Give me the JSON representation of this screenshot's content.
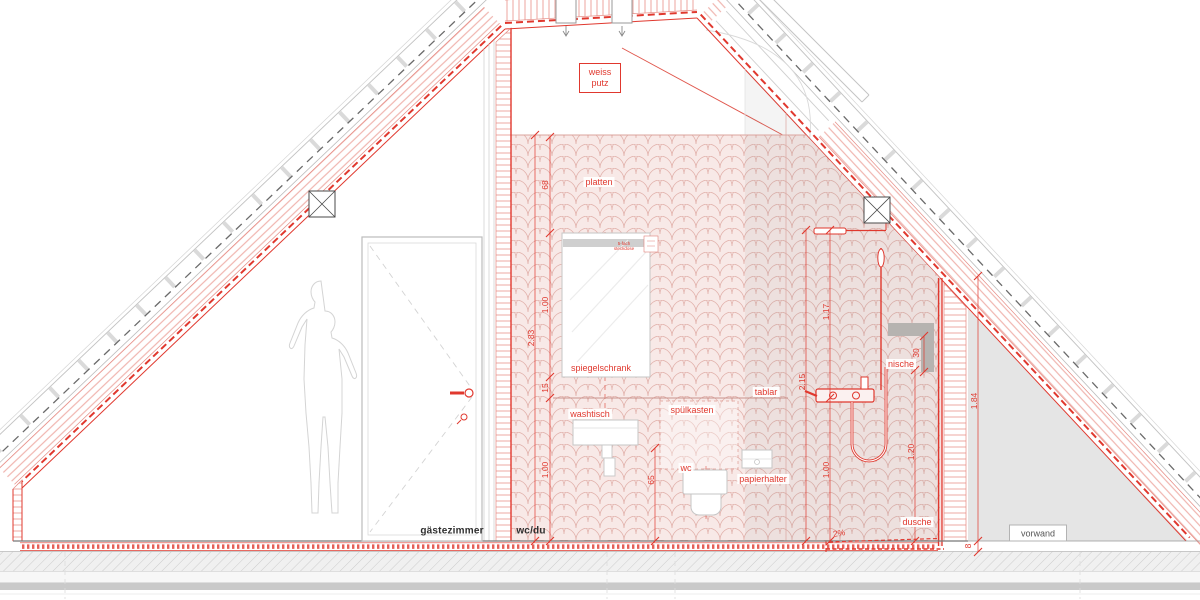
{
  "labels": {
    "weiss_putz_line1": "weiss",
    "weiss_putz_line2": "putz",
    "platten": "platten",
    "spiegelschrank": "spiegelschrank",
    "steckdose_line1": "5-fach",
    "steckdose_line2": "steckdose",
    "washtisch": "washtisch",
    "spuelkasten": "spülkasten",
    "tablar": "tablar",
    "wc": "wc",
    "papierhalter": "papierhalter",
    "dusche": "dusche",
    "nische": "nische",
    "gaestezimmer": "gästezimmer",
    "wc_du": "wc/du",
    "vorwand": "vorwand"
  },
  "dimensions": {
    "wall_height_total": "2.83",
    "tile_band_top": "68",
    "mirror_cabinet_height": "1.00",
    "gap_cabinet_shelf": "15",
    "shelf_height": "1.00",
    "basin_clearance": "65",
    "shower_height": "2.15",
    "head_to_mixer": "1.17",
    "mixer_height": "1.00",
    "niche_bottom_height": "1.20",
    "niche_size": "30",
    "vorwand_height": "1.84",
    "floor_thickness": "8",
    "floor_slope": "2%"
  },
  "colors": {
    "accent_red": "#e0382e",
    "tile_pink": "#f8e9e7",
    "niche_gray": "#b6b3b0",
    "structure_gray": "#c9c9c9"
  }
}
